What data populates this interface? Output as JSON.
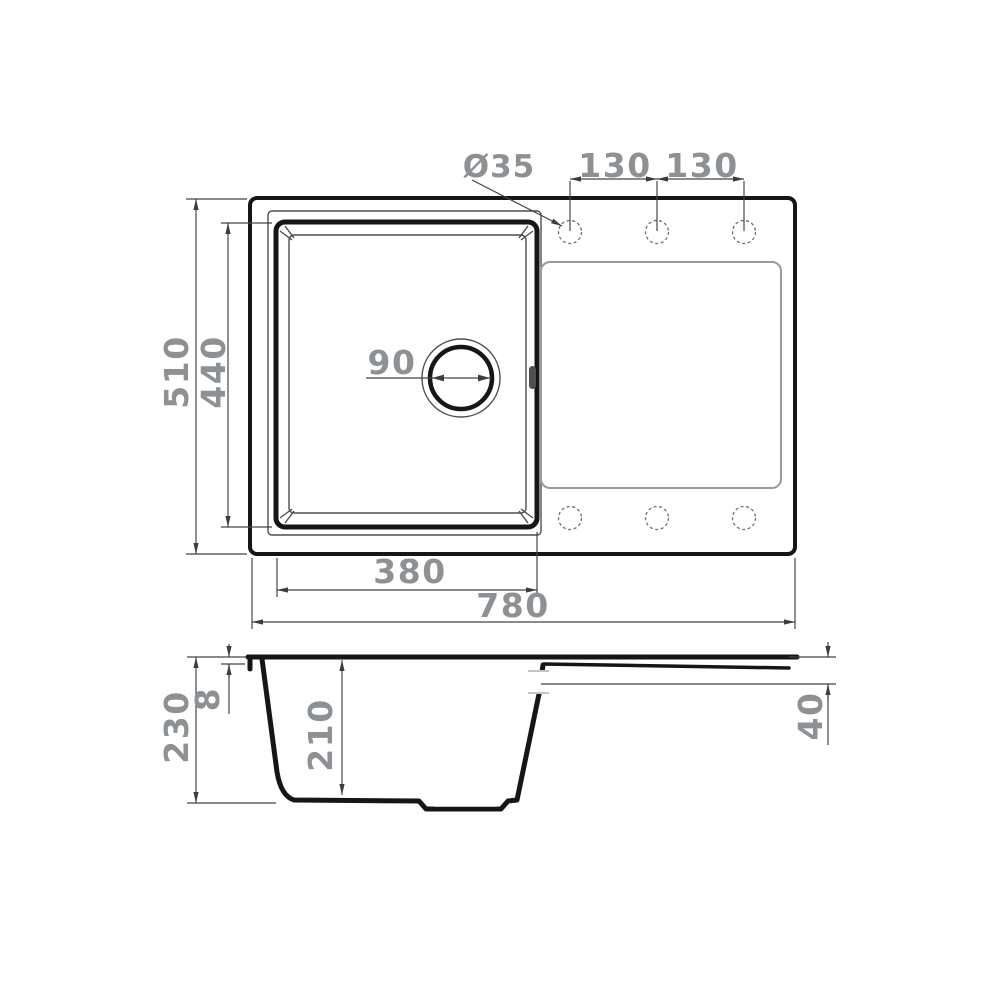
{
  "drawing": {
    "description": "Technical dimension drawing of a kitchen sink with single bowl and drainboard, top view and sectional side view",
    "units": "mm",
    "top_view": {
      "overall_width": "780",
      "overall_depth": "510",
      "bowl_width": "380",
      "bowl_depth": "440",
      "drain_diameter": "90",
      "tap_hole_diameter": "Ø35",
      "tap_hole_spacing_1": "130",
      "tap_hole_spacing_2": "130",
      "tap_hole_count_top": 3,
      "tap_hole_count_bottom": 3
    },
    "side_view": {
      "overall_height": "230",
      "rim_thickness": "8",
      "bowl_inner_depth": "210",
      "drainboard_edge_height": "40"
    },
    "colors": {
      "background": "#ffffff",
      "part_outline": "#161616",
      "dimension_lines": "#454545",
      "dimension_text": "#8d9194",
      "light_lines": "#9b9b9b"
    }
  }
}
